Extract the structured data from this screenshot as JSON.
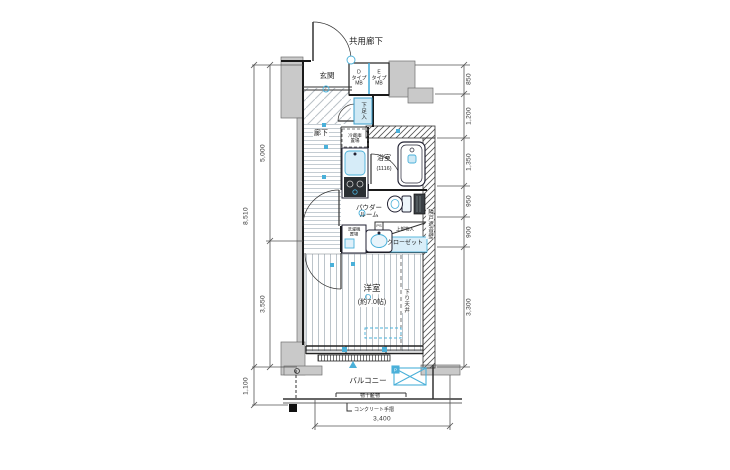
{
  "plan": {
    "labels": {
      "common_corridor": "共用廊下",
      "entrance": "玄関",
      "mb_d": "D\nタイプ\nMB",
      "mb_e": "E\nタイプ\nMB",
      "shoe_box": "下足入",
      "hallway": "廊下",
      "fridge_space": "冷蔵庫\n置場",
      "bathroom": "浴室",
      "bathroom_size": "(1116)",
      "powder_room": "パウダー\nルーム",
      "pipe_space": "PS",
      "upper_storage": "上部物入",
      "closet": "クローゼット",
      "laundry_space": "洗濯機\n置場",
      "sound_wall": "隣戸遮音壁",
      "western_room": "洋室",
      "western_room_size": "(約7.0帖)",
      "lowered_ceiling": "下り天井",
      "balcony": "バルコニー",
      "drying_fixture": "物干金物",
      "concrete_rail": "コンクリート手摺",
      "hatch_tag": "P"
    },
    "dimensions": {
      "left_total": "8,510",
      "left_upper": "5,000",
      "left_lower": "3,550",
      "left_bottom": "1,100",
      "right": [
        "850",
        "1,200",
        "1,350",
        "950",
        "900",
        "3,300"
      ],
      "bottom": "3,400"
    },
    "colors": {
      "accent": "#3fa9d5",
      "wall_fill": "#c9c9c9",
      "line": "#1a1a1a"
    }
  }
}
